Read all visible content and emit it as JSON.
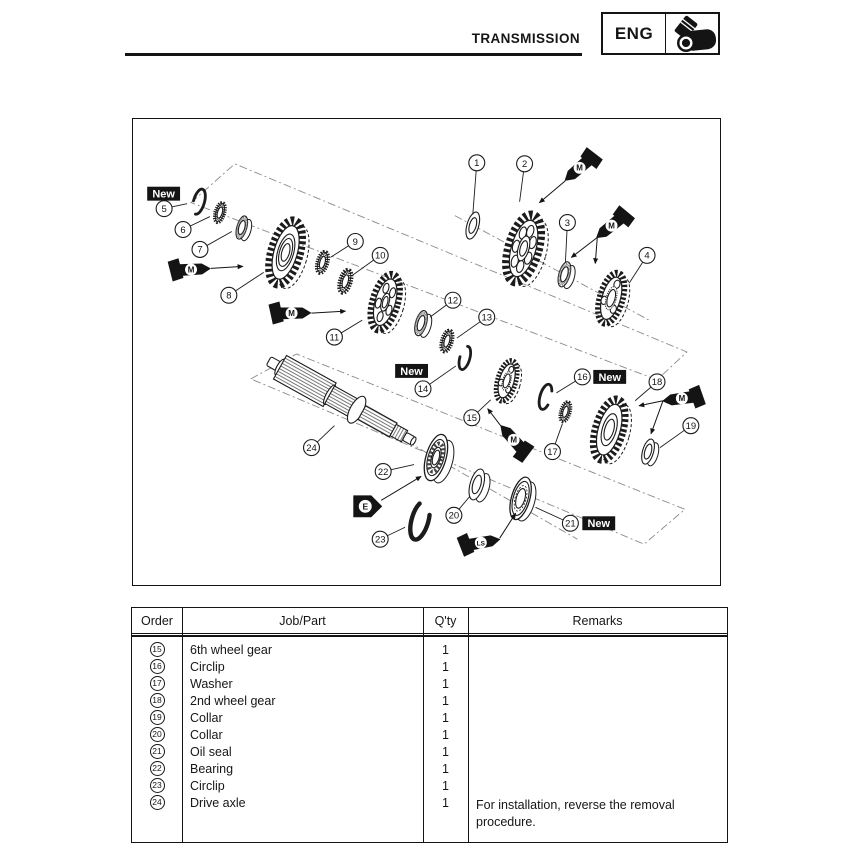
{
  "header": {
    "title": "TRANSMISSION",
    "chapter": "ENG",
    "chapter_icon": "engine-cylinder-icon"
  },
  "table": {
    "headers": [
      "Order",
      "Job/Part",
      "Q'ty",
      "Remarks"
    ],
    "rows": [
      {
        "order": "15",
        "part": "6th wheel gear",
        "qty": "1",
        "remarks": ""
      },
      {
        "order": "16",
        "part": "Circlip",
        "qty": "1",
        "remarks": ""
      },
      {
        "order": "17",
        "part": "Washer",
        "qty": "1",
        "remarks": ""
      },
      {
        "order": "18",
        "part": "2nd wheel gear",
        "qty": "1",
        "remarks": ""
      },
      {
        "order": "19",
        "part": "Collar",
        "qty": "1",
        "remarks": ""
      },
      {
        "order": "20",
        "part": "Collar",
        "qty": "1",
        "remarks": ""
      },
      {
        "order": "21",
        "part": "Oil seal",
        "qty": "1",
        "remarks": ""
      },
      {
        "order": "22",
        "part": "Bearing",
        "qty": "1",
        "remarks": ""
      },
      {
        "order": "23",
        "part": "Circlip",
        "qty": "1",
        "remarks": ""
      },
      {
        "order": "24",
        "part": "Drive axle",
        "qty": "1",
        "remarks": ""
      }
    ],
    "remark": "For installation, reverse the removal procedure."
  },
  "diagram": {
    "callouts": [
      {
        "n": "1",
        "x": 477,
        "y": 162,
        "tx": 473,
        "ty": 214
      },
      {
        "n": "2",
        "x": 525,
        "y": 163,
        "tx": 520,
        "ty": 201
      },
      {
        "n": "3",
        "x": 568,
        "y": 222,
        "tx": 566,
        "ty": 262
      },
      {
        "n": "4",
        "x": 648,
        "y": 255,
        "tx": 630,
        "ty": 283
      },
      {
        "n": "5",
        "x": 163,
        "y": 208,
        "tx": 186,
        "ty": 203
      },
      {
        "n": "6",
        "x": 182,
        "y": 229,
        "tx": 209,
        "ty": 216
      },
      {
        "n": "7",
        "x": 199,
        "y": 249,
        "tx": 231,
        "ty": 231
      },
      {
        "n": "8",
        "x": 228,
        "y": 295,
        "tx": 263,
        "ty": 272
      },
      {
        "n": "9",
        "x": 355,
        "y": 241,
        "tx": 330,
        "ty": 257
      },
      {
        "n": "10",
        "x": 380,
        "y": 255,
        "tx": 352,
        "ty": 275
      },
      {
        "n": "11",
        "x": 334,
        "y": 337,
        "tx": 362,
        "ty": 320
      },
      {
        "n": "12",
        "x": 453,
        "y": 300,
        "tx": 430,
        "ty": 317
      },
      {
        "n": "13",
        "x": 487,
        "y": 317,
        "tx": 457,
        "ty": 338
      },
      {
        "n": "14",
        "x": 423,
        "y": 389,
        "tx": 456,
        "ty": 366
      },
      {
        "n": "15",
        "x": 472,
        "y": 418,
        "tx": 491,
        "ty": 400
      },
      {
        "n": "16",
        "x": 583,
        "y": 377,
        "tx": 557,
        "ty": 393
      },
      {
        "n": "17",
        "x": 553,
        "y": 452,
        "tx": 563,
        "ty": 424
      },
      {
        "n": "18",
        "x": 658,
        "y": 382,
        "tx": 636,
        "ty": 401
      },
      {
        "n": "19",
        "x": 692,
        "y": 426,
        "tx": 661,
        "ty": 448
      },
      {
        "n": "20",
        "x": 454,
        "y": 516,
        "tx": 470,
        "ty": 497
      },
      {
        "n": "21",
        "x": 571,
        "y": 524,
        "tx": 536,
        "ty": 508
      },
      {
        "n": "22",
        "x": 383,
        "y": 472,
        "tx": 414,
        "ty": 465
      },
      {
        "n": "23",
        "x": 380,
        "y": 540,
        "tx": 405,
        "ty": 528
      },
      {
        "n": "24",
        "x": 311,
        "y": 448,
        "tx": 334,
        "ty": 426
      }
    ],
    "new_labels": [
      {
        "text": "New",
        "x": 146,
        "y": 186
      },
      {
        "text": "New",
        "x": 395,
        "y": 364
      },
      {
        "text": "New",
        "x": 594,
        "y": 370
      },
      {
        "text": "New",
        "x": 583,
        "y": 517
      }
    ],
    "applicators": [
      {
        "label": "M",
        "x": 578,
        "y": 169,
        "a": 139,
        "arrows": [
          [
            566,
            180,
            540,
            202
          ]
        ]
      },
      {
        "label": "M",
        "x": 610,
        "y": 227,
        "a": 141,
        "arrows": [
          [
            598,
            237,
            572,
            257
          ],
          [
            598,
            237,
            596,
            263
          ]
        ]
      },
      {
        "label": "M",
        "x": 193,
        "y": 269,
        "a": -3,
        "arrows": [
          [
            210,
            268,
            242,
            266
          ]
        ]
      },
      {
        "label": "M",
        "x": 294,
        "y": 313,
        "a": -1,
        "arrows": [
          [
            311,
            313,
            345,
            311
          ]
        ]
      },
      {
        "label": "M",
        "x": 512,
        "y": 438,
        "a": 228,
        "arrows": [
          [
            501,
            426,
            488,
            409
          ]
        ]
      },
      {
        "label": "M",
        "x": 680,
        "y": 399,
        "a": 172,
        "arrows": [
          [
            664,
            401,
            640,
            406
          ],
          [
            664,
            401,
            652,
            434
          ]
        ]
      },
      {
        "label": "LS",
        "x": 484,
        "y": 543,
        "a": -10,
        "arrows": [
          [
            500,
            539,
            516,
            514
          ]
        ]
      }
    ],
    "tags": [
      {
        "label": "E",
        "x": 368,
        "y": 507,
        "arrows": [
          [
            381,
            501,
            421,
            477
          ]
        ]
      }
    ],
    "parts_back": [
      {
        "name": "circlip-5",
        "type": "circlip",
        "x": 198,
        "y": 201,
        "r": 13,
        "gap": 51
      },
      {
        "name": "washer-6",
        "type": "spline-washer",
        "x": 219,
        "y": 212,
        "r": 12
      },
      {
        "name": "collar-7",
        "type": "collar",
        "x": 241,
        "y": 227,
        "r": 12,
        "knurl": true
      },
      {
        "name": "gear-8",
        "type": "gear",
        "x": 285,
        "y": 252,
        "r": 38,
        "holes": 0,
        "rings": [
          0.5,
          0.38,
          0.24
        ]
      },
      {
        "name": "washer-9",
        "type": "spline-washer",
        "x": 322,
        "y": 262,
        "r": 13
      },
      {
        "name": "washer-10",
        "type": "spline-washer",
        "x": 345,
        "y": 281,
        "r": 14
      },
      {
        "name": "gear-11",
        "type": "gear",
        "x": 385,
        "y": 302,
        "r": 33,
        "holes": 5,
        "rings": [
          0.28,
          0.18
        ]
      },
      {
        "name": "collar-12",
        "type": "collar",
        "x": 421,
        "y": 323,
        "r": 13,
        "knurl": true
      },
      {
        "name": "washer-13",
        "type": "spline-washer",
        "x": 447,
        "y": 341,
        "r": 13
      },
      {
        "name": "circlip-14",
        "type": "circlip",
        "x": 465,
        "y": 358,
        "r": 12,
        "gap": 26
      },
      {
        "name": "gear-15",
        "type": "dog-gear",
        "x": 507,
        "y": 381,
        "r": 24
      },
      {
        "name": "circlip-16",
        "type": "circlip",
        "x": 546,
        "y": 397,
        "r": 13,
        "gap": 88
      },
      {
        "name": "washer-17",
        "type": "spline-washer",
        "x": 566,
        "y": 412,
        "r": 12
      },
      {
        "name": "gear-18",
        "type": "gear",
        "x": 610,
        "y": 430,
        "r": 36,
        "holes": 0,
        "rings": [
          0.46,
          0.3
        ]
      },
      {
        "name": "collar-19",
        "type": "collar",
        "x": 649,
        "y": 452,
        "r": 13
      },
      {
        "name": "washer-1",
        "type": "washer",
        "x": 473,
        "y": 225,
        "r": 14
      },
      {
        "name": "gear-2",
        "type": "gear",
        "x": 524,
        "y": 248,
        "r": 40,
        "holes": 7,
        "rings": [
          0.32,
          0.2
        ]
      },
      {
        "name": "collar-3",
        "type": "collar",
        "x": 565,
        "y": 274,
        "r": 13,
        "knurl": true
      },
      {
        "name": "gear-4",
        "type": "dog-gear",
        "x": 612,
        "y": 298,
        "r": 30
      }
    ],
    "parts_front": [
      {
        "name": "bearing-22",
        "type": "bearing",
        "x": 436,
        "y": 458,
        "r": 24
      },
      {
        "name": "collar-20",
        "type": "collar",
        "x": 477,
        "y": 485,
        "r": 16
      },
      {
        "name": "oil-seal-21",
        "type": "oil-seal",
        "x": 521,
        "y": 499,
        "r": 22
      },
      {
        "name": "circlip-23",
        "type": "circlip",
        "x": 420,
        "y": 521,
        "r": 20,
        "gap": 0
      }
    ]
  }
}
